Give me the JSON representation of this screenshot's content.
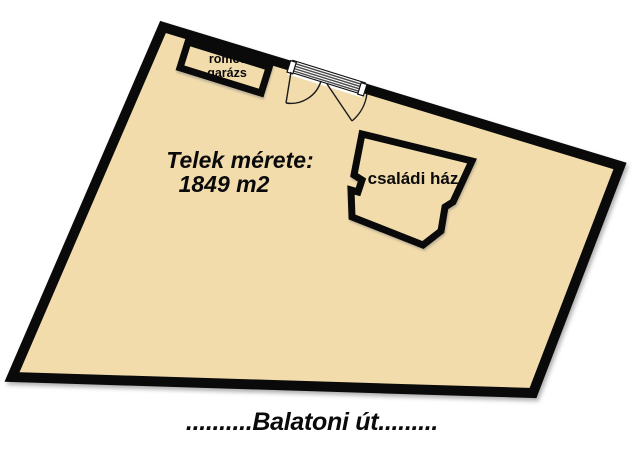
{
  "colors": {
    "plot_fill": "#F2DCAC",
    "outline": "#0a0a0a",
    "background": "#ffffff"
  },
  "plot": {
    "size_label_line1": "Telek mérete:",
    "size_label_line2": "1849 m2"
  },
  "garage": {
    "label_line1": "romos",
    "label_line2": "garázs"
  },
  "house": {
    "label": "családi ház"
  },
  "gate": {
    "icon": "double-gate-icon"
  },
  "street": {
    "label": "..........Balatoni út........."
  }
}
